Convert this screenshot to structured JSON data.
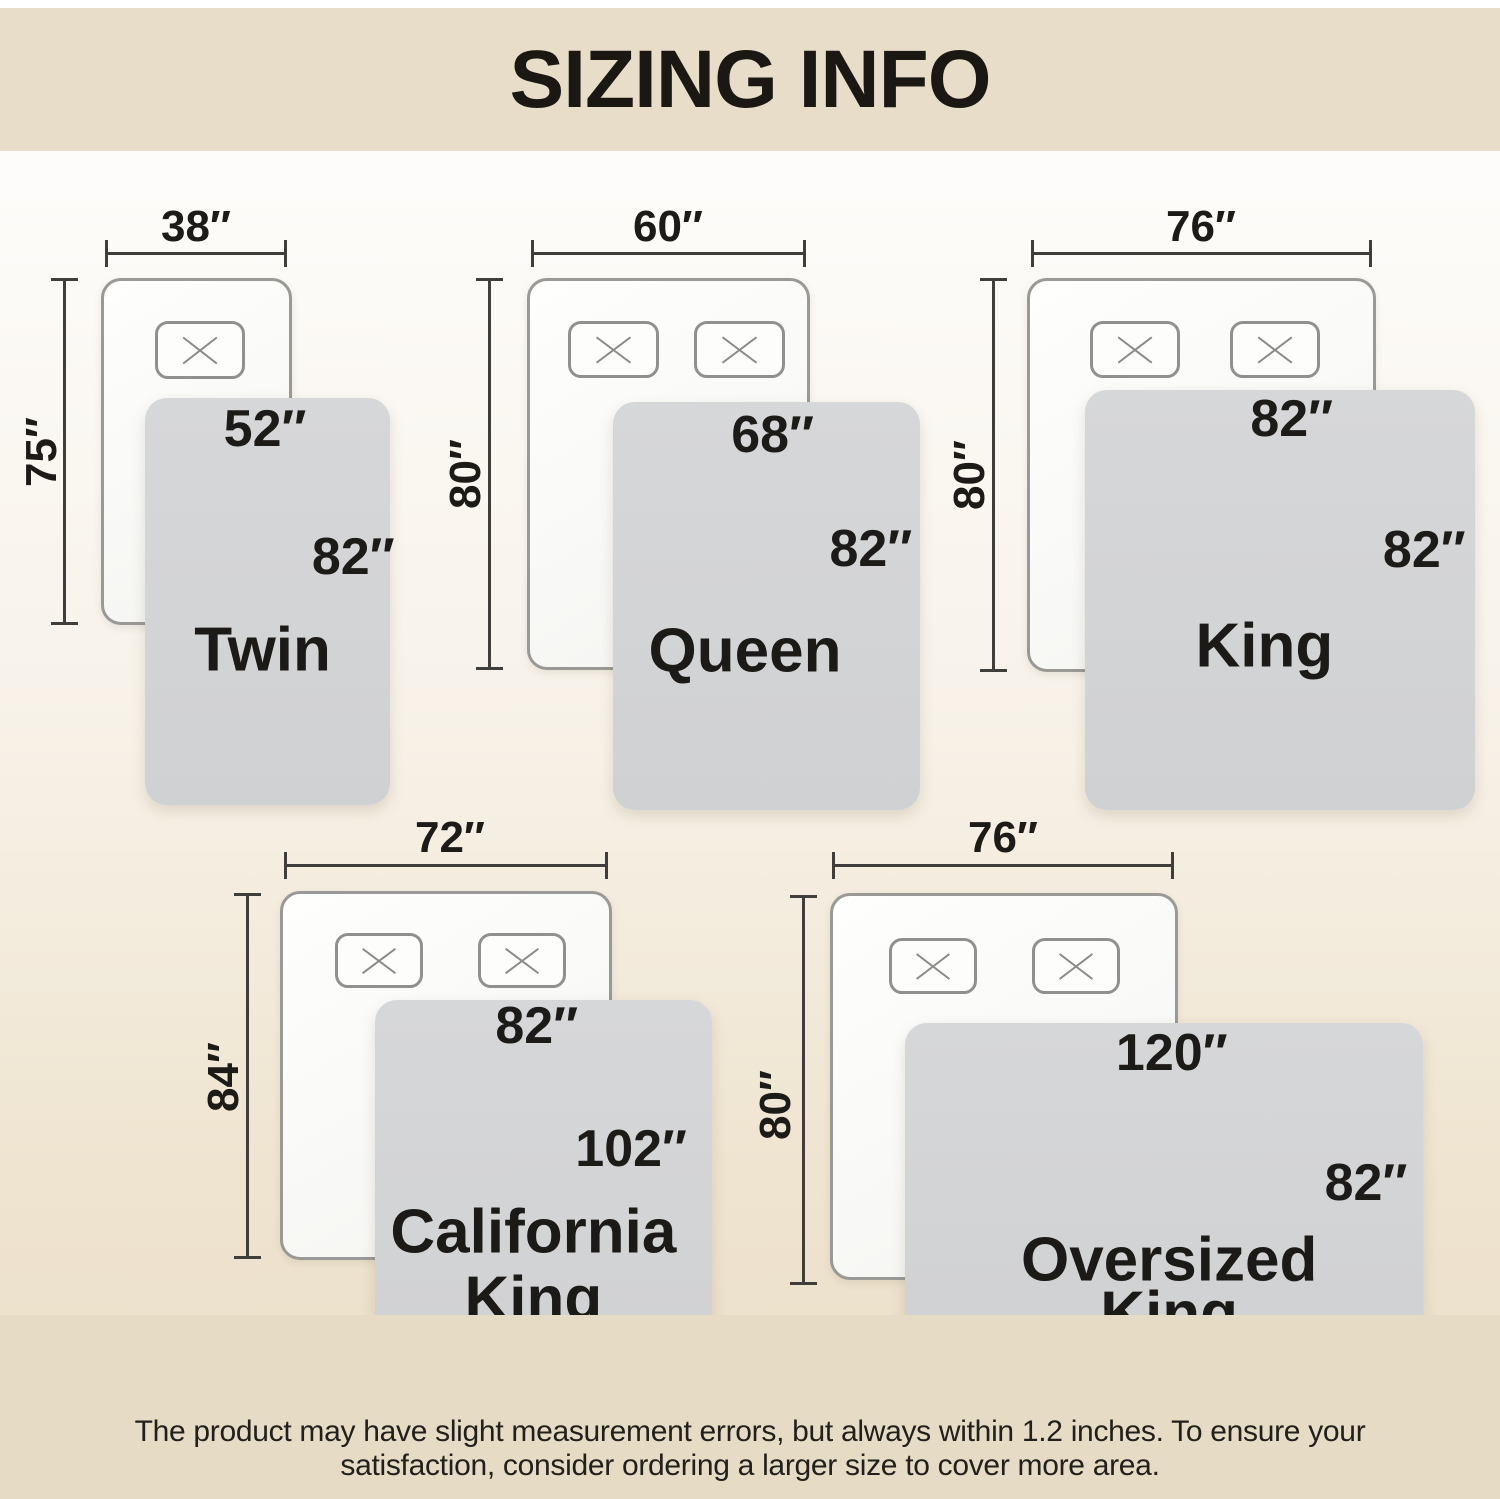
{
  "title": "SIZING INFO",
  "footer": {
    "line1": "The product may have slight measurement errors, but always within 1.2 inches. To ensure your",
    "line2": "satisfaction, consider ordering a larger size to cover more area."
  },
  "sizes": [
    {
      "name": "Twin",
      "mattress_width": "38″",
      "mattress_length": "75″",
      "blanket_width": "52″",
      "blanket_length": "82″",
      "pillows": 1
    },
    {
      "name": "Queen",
      "mattress_width": "60″",
      "mattress_length": "80″",
      "blanket_width": "68″",
      "blanket_length": "82″",
      "pillows": 2
    },
    {
      "name": "King",
      "mattress_width": "76″",
      "mattress_length": "80″",
      "blanket_width": "82″",
      "blanket_length": "82″",
      "pillows": 2
    },
    {
      "name": "California King",
      "name_line1": "California",
      "name_line2": "King",
      "mattress_width": "72″",
      "mattress_length": "84″",
      "blanket_width": "82″",
      "blanket_length": "102″",
      "pillows": 2
    },
    {
      "name": "Oversized King",
      "name_line1": "Oversized",
      "name_line2": "King",
      "mattress_width": "76″",
      "mattress_length": "80″",
      "blanket_width": "120″",
      "blanket_length": "82″",
      "pillows": 2
    }
  ],
  "colors": {
    "banner_bg": "#e7ddc8",
    "footer_bg": "#e6dcc6",
    "text": "#1d1b18",
    "blanket_fill": "#d3d4d6",
    "mattress_fill": "#fafaf8",
    "mattress_border": "#9a9995",
    "pillow_border": "#90908c",
    "dimension_line": "#403e3b"
  }
}
